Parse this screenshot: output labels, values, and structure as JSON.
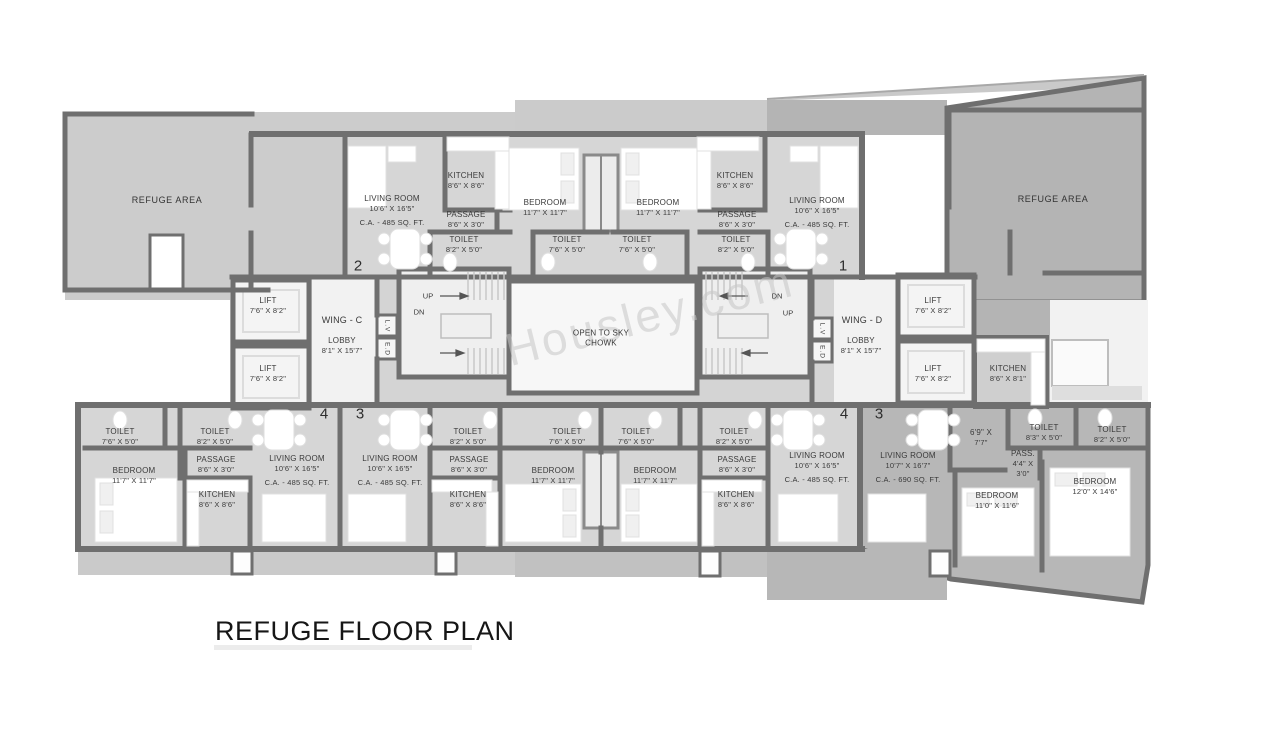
{
  "title": "REFUGE FLOOR PLAN",
  "watermark": "Housley.com",
  "colors": {
    "wall": "#6f6f6f",
    "flat_floor": "#d6d6d6",
    "refuge_floor": "#cccccc",
    "refuge_dark": "#b4b4b4",
    "room_white": "#f4f4f4"
  },
  "refuge": {
    "left": "REFUGE AREA",
    "right": "REFUGE AREA"
  },
  "wings": {
    "c": "WING - C",
    "d": "WING - D"
  },
  "chowk": {
    "l1": "OPEN TO SKY",
    "l2": "CHOWK"
  },
  "stairs": {
    "up": "UP",
    "dn": "DN"
  },
  "shafts": {
    "lv": "L.V",
    "ed": "E.D"
  },
  "markers": {
    "m1": "1",
    "m2": "2",
    "m3": "3",
    "m4": "4"
  },
  "labels": {
    "lr_c2": {
      "n": "LIVING ROOM",
      "d": "10'6\" X 16'5\"",
      "ca": "C.A. - 485 SQ. FT."
    },
    "kit_c2": {
      "n": "KITCHEN",
      "d": "8'6\" X 8'6\""
    },
    "pas_c2": {
      "n": "PASSAGE",
      "d": "8'6\" X 3'0\""
    },
    "toi_c2": {
      "n": "TOILET",
      "d": "8'2\" X 5'0\""
    },
    "bed_2": {
      "n": "BEDROOM",
      "d": "11'7\" X 11'7\""
    },
    "toi_2": {
      "n": "TOILET",
      "d": "7'6\" X 5'0\""
    },
    "toi_1": {
      "n": "TOILET",
      "d": "7'6\" X 5'0\""
    },
    "bed_1": {
      "n": "BEDROOM",
      "d": "11'7\" X 11'7\""
    },
    "kit_d1": {
      "n": "KITCHEN",
      "d": "8'6\" X 8'6\""
    },
    "pas_d1": {
      "n": "PASSAGE",
      "d": "8'6\" X 3'0\""
    },
    "toi_d1": {
      "n": "TOILET",
      "d": "8'2\" X 5'0\""
    },
    "lr_d1": {
      "n": "LIVING ROOM",
      "d": "10'6\" X 16'5\"",
      "ca": "C.A. - 485 SQ. FT."
    },
    "lift_c1": {
      "n": "LIFT",
      "d": "7'6\" X 8'2\""
    },
    "lift_c2": {
      "n": "LIFT",
      "d": "7'6\" X 8'2\""
    },
    "lobby_c": {
      "n": "LOBBY",
      "d": "8'1\" X 15'7\""
    },
    "lobby_d": {
      "n": "LOBBY",
      "d": "8'1\" X 15'7\""
    },
    "lift_d1": {
      "n": "LIFT",
      "d": "7'6\" X 8'2\""
    },
    "lift_d2": {
      "n": "LIFT",
      "d": "7'6\" X 8'2\""
    },
    "kit_d": {
      "n": "KITCHEN",
      "d": "8'6\" X 8'1\""
    },
    "toi_c4a": {
      "n": "TOILET",
      "d": "7'6\" X 5'0\""
    },
    "toi_c4b": {
      "n": "TOILET",
      "d": "8'2\" X 5'0\""
    },
    "pas_c4": {
      "n": "PASSAGE",
      "d": "8'6\" X 3'0\""
    },
    "bed_c4": {
      "n": "BEDROOM",
      "d": "11'7\" X 11'7\""
    },
    "kit_c4": {
      "n": "KITCHEN",
      "d": "8'6\" X 8'6\""
    },
    "lr_c4": {
      "n": "LIVING ROOM",
      "d": "10'6\" X 16'5\"",
      "ca": "C.A. - 485 SQ. FT."
    },
    "lr_c3": {
      "n": "LIVING ROOM",
      "d": "10'6\" X 16'5\"",
      "ca": "C.A. - 485 SQ. FT."
    },
    "toi_c3a": {
      "n": "TOILET",
      "d": "8'2\" X 5'0\""
    },
    "pas_c3": {
      "n": "PASSAGE",
      "d": "8'6\" X 3'0\""
    },
    "kit_c3": {
      "n": "KITCHEN",
      "d": "8'6\" X 8'6\""
    },
    "toi_c3b": {
      "n": "TOILET",
      "d": "7'6\" X 5'0\""
    },
    "bed_c3": {
      "n": "BEDROOM",
      "d": "11'7\" X 11'7\""
    },
    "toi_d4a": {
      "n": "TOILET",
      "d": "7'6\" X 5'0\""
    },
    "bed_d4": {
      "n": "BEDROOM",
      "d": "11'7\" X 11'7\""
    },
    "toi_d4b": {
      "n": "TOILET",
      "d": "8'2\" X 5'0\""
    },
    "pas_d4": {
      "n": "PASSAGE",
      "d": "8'6\" X 3'0\""
    },
    "kit_d4": {
      "n": "KITCHEN",
      "d": "8'6\" X 8'6\""
    },
    "lr_d4": {
      "n": "LIVING ROOM",
      "d": "10'6\" X 16'5\"",
      "ca": "C.A. - 485 SQ. FT."
    },
    "lr_d3": {
      "n": "LIVING ROOM",
      "d": "10'7\" X 16'7\"",
      "ca": "C.A. - 690 SQ. FT."
    },
    "foy_d3": {
      "n": "6'9\" X",
      "d": "7'7\""
    },
    "toi_d3a": {
      "n": "TOILET",
      "d": "8'3\" X 5'0\""
    },
    "toi_d3b": {
      "n": "TOILET",
      "d": "8'2\" X 5'0\""
    },
    "pass_d3": {
      "n": "PASS.",
      "d": "4'4\" X",
      "d2": "3'0\""
    },
    "bed_d3a": {
      "n": "BEDROOM",
      "d": "11'0\" X 11'6\""
    },
    "bed_d3b": {
      "n": "BEDROOM",
      "d": "12'0\" X 14'6\""
    }
  }
}
